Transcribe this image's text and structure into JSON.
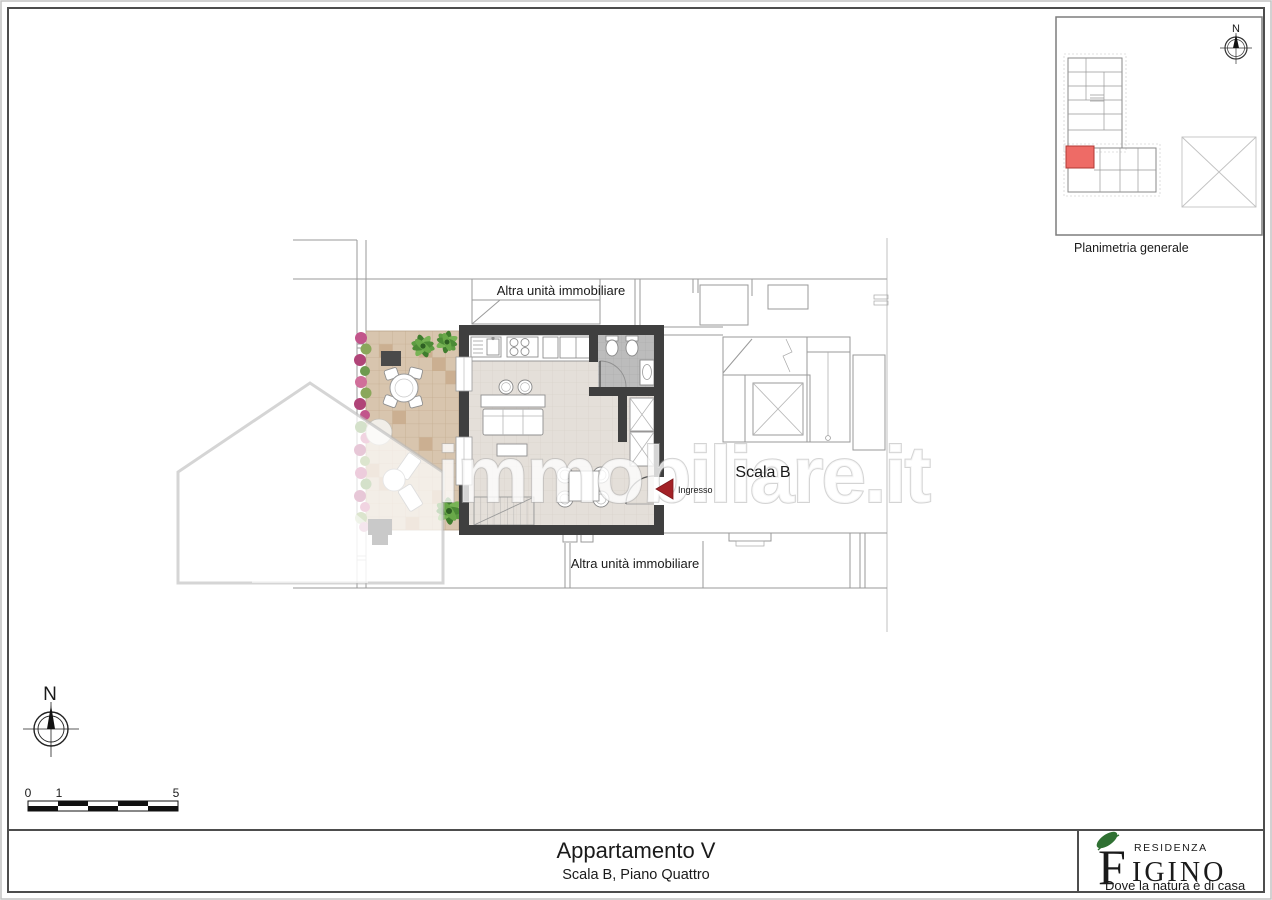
{
  "colors": {
    "arrow_red": "#a32126",
    "unit_highlight": "#ee6b66",
    "wall": "#3f3f3f",
    "terrace": "#d8c5ae",
    "logo_green_dark": "#2f7032",
    "logo_green_light": "#86b33c"
  },
  "plan": {
    "label_altra_top": "Altra unità immobiliare",
    "label_altra_bottom": "Altra unità immobiliare",
    "label_scala": "Scala B",
    "label_ingresso": "Ingresso"
  },
  "inset": {
    "label": "Planimetria generale",
    "compass_n": "N"
  },
  "compass": {
    "n": "N"
  },
  "scalebar": {
    "t0": "0",
    "t1": "1",
    "t5": "5"
  },
  "watermark": {
    "text": "immobiliare",
    "tld": ".it"
  },
  "titleblock": {
    "title": "Appartamento V",
    "subtitle": "Scala B, Piano Quattro"
  },
  "logo": {
    "brand_top": "RESIDENZA",
    "initial": "F",
    "rest": "IGINO",
    "tagline": "Dove la natura è di casa"
  }
}
